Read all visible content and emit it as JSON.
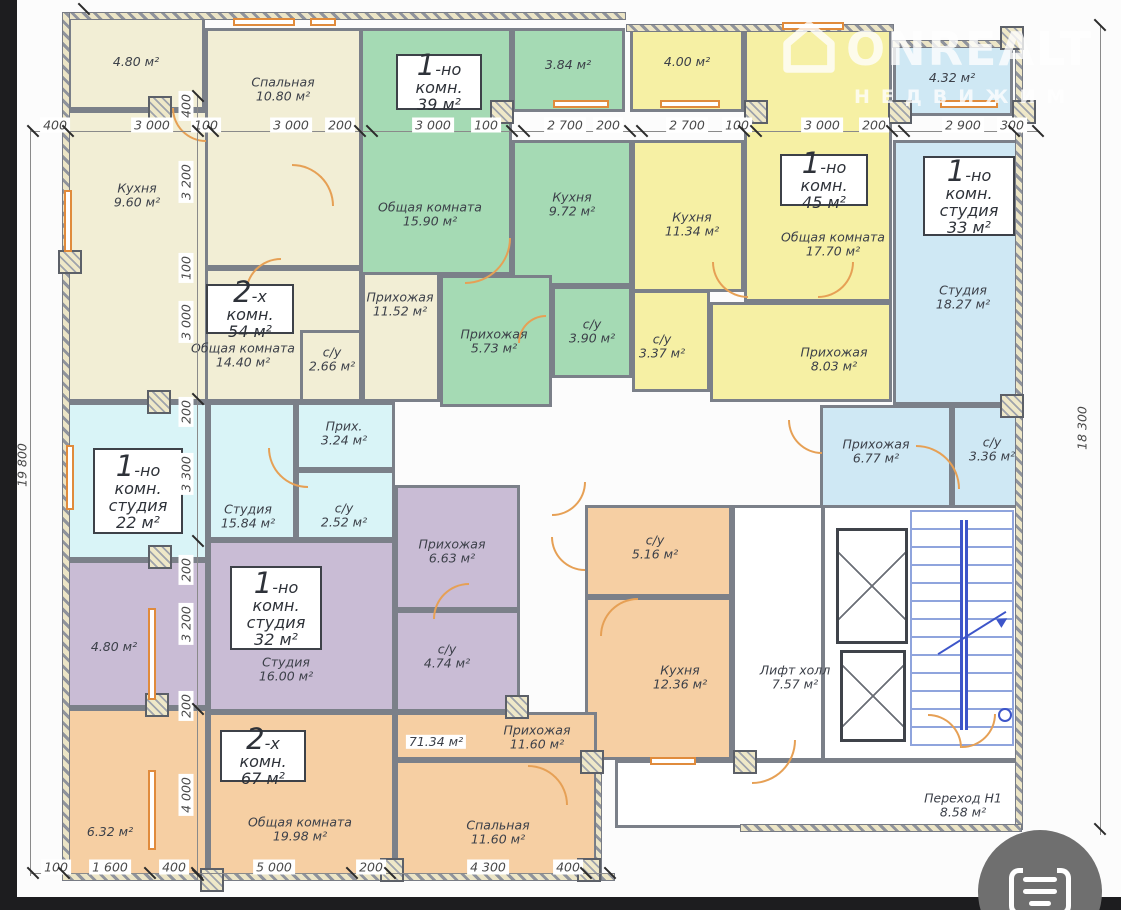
{
  "palette": {
    "cream": "#f2eed5",
    "green": "#a5dab4",
    "yellow": "#f6f0a4",
    "blue": "#cfe8f4",
    "cyan": "#d9f4f7",
    "purple": "#c9bcd5",
    "orange": "#f6cfa3",
    "door_accent": "#e6a055",
    "wall": "#7b8089",
    "stairs": "#8fa4dd"
  },
  "watermark": {
    "brand": "ONREALT",
    "tagline": "НЕДВИЖИМ"
  },
  "units": {
    "u54": {
      "l1": "2-х комн.",
      "l2": "54 м²"
    },
    "u39": {
      "l1": "1-но комн.",
      "l2": "39 м²"
    },
    "u45": {
      "l1": "1-но комн.",
      "l2": "45 м²"
    },
    "u33": {
      "l1": "1-но комн.",
      "l2": "студия",
      "l3": "33 м²"
    },
    "u22": {
      "l1": "1-но комн.",
      "l2": "студия",
      "l3": "22 м²"
    },
    "u32": {
      "l1": "1-но комн.",
      "l2": "студия",
      "l3": "32 м²"
    },
    "u67": {
      "l1": "2-х комн.",
      "l2": "67 м²"
    }
  },
  "rooms": {
    "cream_balcony": {
      "area": "4.80 м²"
    },
    "cream_bedroom": {
      "name": "Спальная",
      "area": "10.80 м²"
    },
    "cream_kitchen": {
      "name": "Кухня",
      "area": "9.60 м²"
    },
    "cream_living": {
      "name": "Общая комната",
      "area": "14.40 м²"
    },
    "cream_wc": {
      "name": "с/у",
      "area": "2.66 м²"
    },
    "cream_hall": {
      "name": "Прихожая",
      "area": "11.52 м²"
    },
    "green_living": {
      "name": "Общая комната",
      "area": "15.90 м²"
    },
    "green_kitchen": {
      "name": "Кухня",
      "area": "9.72 м²"
    },
    "green_balcony": {
      "area": "3.84 м²"
    },
    "green_hall": {
      "name": "Прихожая",
      "area": "5.73 м²"
    },
    "green_wc": {
      "name": "с/у",
      "area": "3.90 м²"
    },
    "yellow_balcony": {
      "area": "4.00 м²"
    },
    "yellow_kitchen": {
      "name": "Кухня",
      "area": "11.34 м²"
    },
    "yellow_living": {
      "name": "Общая комната",
      "area": "17.70 м²"
    },
    "yellow_wc": {
      "name": "с/у",
      "area": "3.37 м²"
    },
    "yellow_hall": {
      "name": "Прихожая",
      "area": "8.03 м²"
    },
    "blue_balcony": {
      "area": "4.32 м²"
    },
    "blue_studio": {
      "name": "Студия",
      "area": "18.27 м²"
    },
    "blue_hall": {
      "name": "Прихожая",
      "area": "6.77 м²"
    },
    "blue_wc": {
      "name": "с/у",
      "area": "3.36 м²"
    },
    "cyan_studio": {
      "name": "Студия",
      "area": "15.84 м²"
    },
    "cyan_hall": {
      "name": "Прих.",
      "area": "3.24 м²"
    },
    "cyan_wc": {
      "name": "с/у",
      "area": "2.52 м²"
    },
    "purple_balcony": {
      "area": "4.80 м²"
    },
    "purple_studio": {
      "name": "Студия",
      "area": "16.00 м²"
    },
    "purple_hall": {
      "name": "Прихожая",
      "area": "6.63 м²"
    },
    "purple_wc": {
      "name": "с/у",
      "area": "4.74 м²"
    },
    "orange_wc": {
      "name": "с/у",
      "area": "5.16 м²"
    },
    "orange_kitchen": {
      "name": "Кухня",
      "area": "12.36 м²"
    },
    "orange_hall": {
      "name": "Прихожая",
      "area": "11.60 м²"
    },
    "orange_note": {
      "area": "71.34 м²"
    },
    "orange_living": {
      "name": "Общая комната",
      "area": "19.98 м²"
    },
    "orange_bedroom": {
      "name": "Спальная",
      "area": "11.60 м²"
    },
    "orange_balcony": {
      "area": "6.32 м²"
    },
    "lift_hall": {
      "name": "Лифт холл",
      "area": "7.57 м²"
    },
    "perehod": {
      "name": "Переход Н1",
      "area": "8.58 м²"
    }
  },
  "dims": {
    "top": [
      "400",
      "3 000",
      "100",
      "3 000",
      "200",
      "3 000",
      "100",
      "2 700",
      "200",
      "2 700",
      "100",
      "3 000",
      "200",
      "2 900",
      "300"
    ],
    "bottom": [
      "100",
      "1 600",
      "400",
      "5 000",
      "200",
      "4 300",
      "400"
    ],
    "vchain": [
      "400",
      "3 200",
      "100",
      "3 000",
      "200",
      "3 300",
      "200",
      "3 200",
      "200",
      "4 000"
    ],
    "left_total": "19 800",
    "right_total": "18 300"
  }
}
